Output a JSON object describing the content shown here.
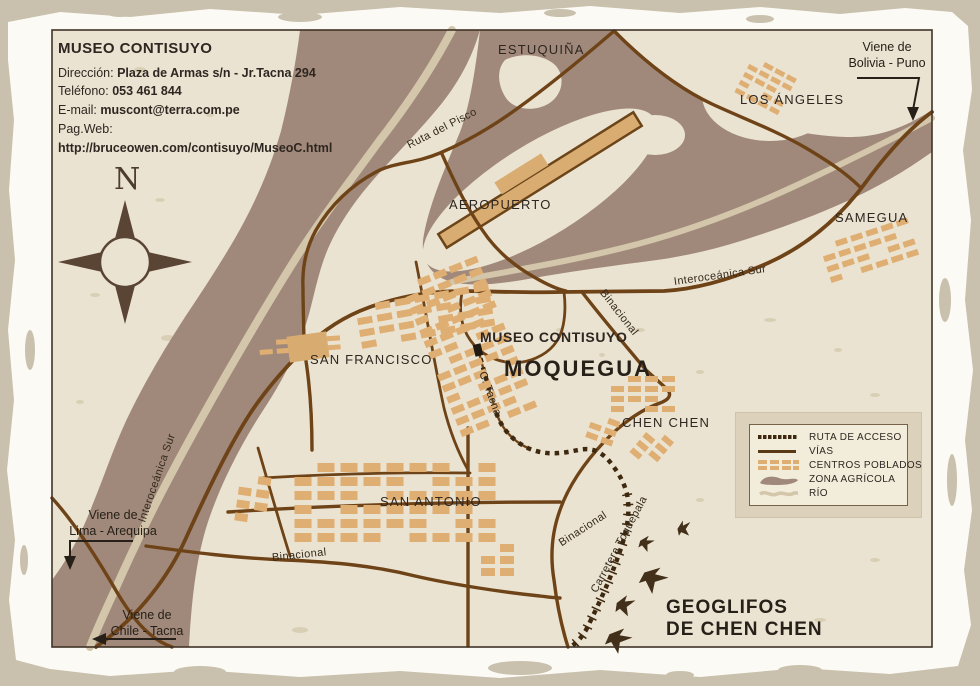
{
  "colors": {
    "paper_outer": "#c9c0ad",
    "paper_sheet": "#fbfaf4",
    "map_background": "#ebe3d1",
    "agricultural_zone": "#a0897a",
    "river": "#d3c6ab",
    "road": "#6e4317",
    "access_route": "#3e2910",
    "populated_blocks": "#dfae72",
    "text": "#2e2620"
  },
  "info_box": {
    "title": "MUSEO CONTISUYO",
    "direccion_label": "Dirección:",
    "direccion_value": "Plaza de Armas s/n - Jr.Tacna 294",
    "telefono_label": "Teléfono:",
    "telefono_value": "053 461 844",
    "email_label": "E-mail:",
    "email_value": "muscont@terra.com.pe",
    "web_label": "Pag.Web:",
    "web_url": "http://bruceowen.com/contisuyo/MuseoC.html"
  },
  "compass": {
    "north_label": "N"
  },
  "map": {
    "places": {
      "estuquina": "ESTUQUIÑA",
      "los_angeles": "LOS ÁNGELES",
      "samegua": "SAMEGUA",
      "aeropuerto": "AEROPUERTO",
      "san_francisco": "SAN FRANCISCO",
      "museo_contisuyo": "MUSEO CONTISUYO",
      "moquegua": "MOQUEGUA",
      "chen_chen": "CHEN CHEN",
      "san_antonio": "SAN ANTONIO",
      "geoglifos_line1": "GEOGLIFOS",
      "geoglifos_line2": "DE CHEN CHEN"
    },
    "roads": {
      "ruta_del_pisco": "Ruta del Pisco",
      "interoceanica_top": "Interoceánica Sur",
      "binacional_ne": "Binacional",
      "c_tacna": "C. Tacna",
      "interoceanica_sw": "Interoceánica Sur",
      "binacional_s": "Binacional",
      "binacional_se": "Binacional",
      "carretera_toquepala": "Carretera Toquepala"
    },
    "directions": {
      "bolivia_line1": "Viene de",
      "bolivia_line2": "Bolivia - Puno",
      "lima_line1": "Viene de",
      "lima_line2": "Lima - Arequipa",
      "chile_line1": "Viene de",
      "chile_line2": "Chile - Tacna"
    }
  },
  "legend": {
    "items": [
      {
        "label": "RUTA DE ACCESO"
      },
      {
        "label": "VÍAS"
      },
      {
        "label": "CENTROS POBLADOS"
      },
      {
        "label": "ZONA AGRÍCOLA"
      },
      {
        "label": "RÍO"
      }
    ]
  }
}
